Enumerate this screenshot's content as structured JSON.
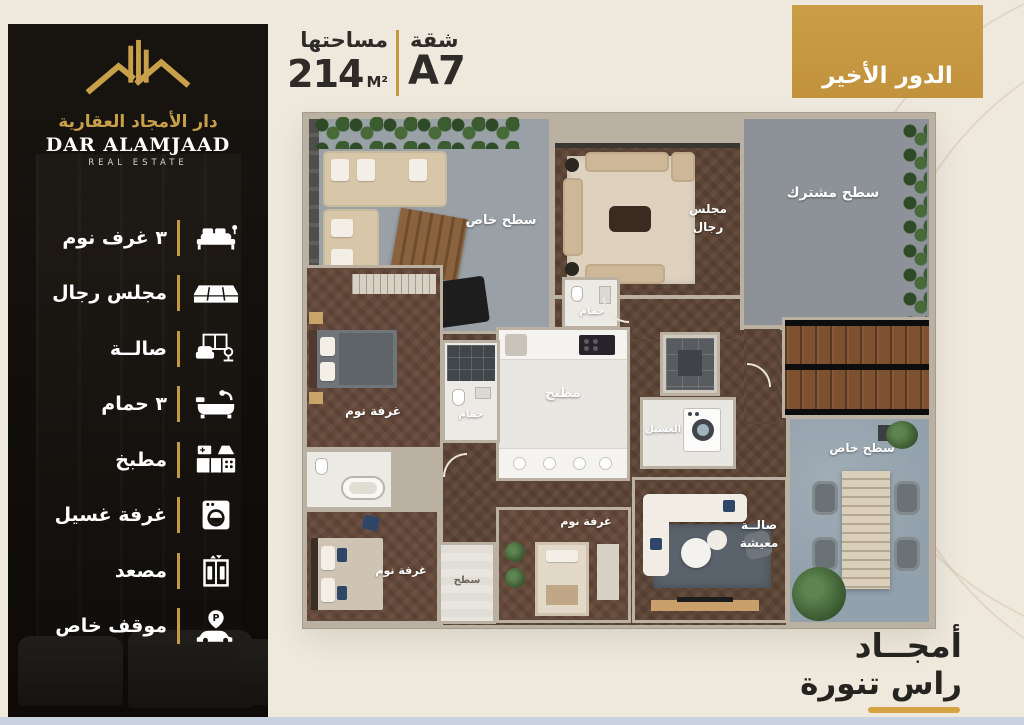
{
  "brand": {
    "logo_title_ar": "دار الأمجاد العقارية",
    "logo_title_en": "DAR ALAMJAAD",
    "logo_subtitle_en": "REAL ESTATE"
  },
  "header": {
    "area_label": "مساحتها",
    "area_value": "214",
    "area_unit": "M²",
    "unit_label": "شقة",
    "unit_value": "A7",
    "floor_badge": "الدور الأخير"
  },
  "sidebar": {
    "parking_letter": "P"
  },
  "features": [
    {
      "label": "٣ غرف نوم",
      "icon": "bed-icon"
    },
    {
      "label": "مجلس رجال",
      "icon": "sectional-sofa-icon"
    },
    {
      "label": "صالــة",
      "icon": "living-room-icon"
    },
    {
      "label": "٣ حمام",
      "icon": "bathtub-icon"
    },
    {
      "label": "مطبخ",
      "icon": "kitchen-icon"
    },
    {
      "label": "غرفة غسيل",
      "icon": "washing-machine-icon"
    },
    {
      "label": "مصعد",
      "icon": "elevator-icon"
    },
    {
      "label": "موقف خاص",
      "icon": "parking-icon"
    }
  ],
  "floorplan": {
    "labels": {
      "terrace_top": "سطح خاص",
      "terrace_shared": "سطح مشترك",
      "majlis": [
        "مجلس",
        "رجال"
      ],
      "bathroom_top": "حمام",
      "bathroom_mid": "حمام",
      "bedroom_master": "غرفة نوم",
      "kitchen": "مطبخ",
      "laundry": "الغسيل",
      "terrace_right": "سطح خاص",
      "living": [
        "صالــة",
        "معيشة"
      ],
      "bedroom_mid": "غرفة نوم",
      "bedroom_left": "غرفة نوم",
      "terrace_small": "سطح"
    }
  },
  "footer": {
    "brand_line1": "أمجــاد",
    "brand_line2": "راس تنورة"
  },
  "colors": {
    "accent_gold": "#c59843",
    "cream_bg": "#efe9dd",
    "sidebar_dark": "#16130f",
    "wall": "#bab1a3",
    "wood_floor": "#5d4536",
    "terrace_gray": "#9aa1a6",
    "terrace_shared_gray": "#8d9298",
    "terrace_blue_gray": "#93a1ac",
    "white_floor": "#eceae5"
  }
}
